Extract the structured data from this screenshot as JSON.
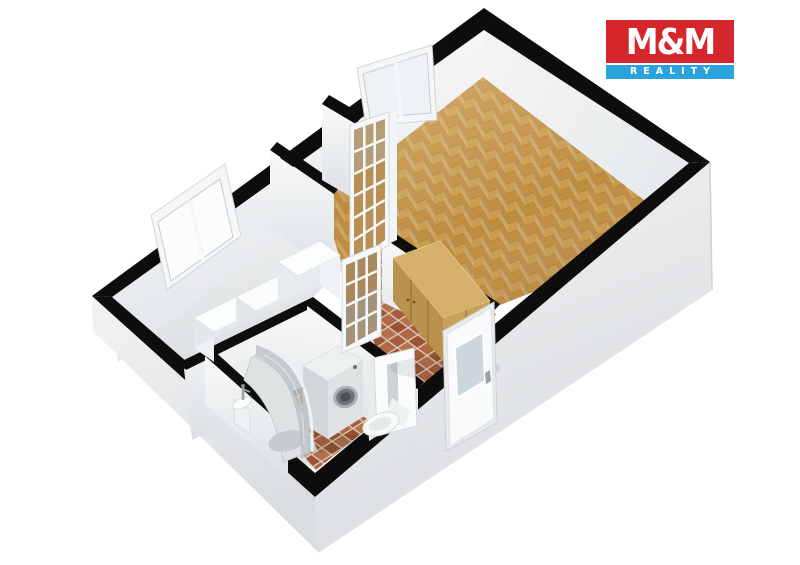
{
  "brand": {
    "name": "M&M",
    "tagline": "REALITY",
    "colors": {
      "red": "#d5262c",
      "blue": "#2aa3dd",
      "text": "#ffffff"
    }
  },
  "scene": {
    "type": "3d-floor-plan-render",
    "background": "#ffffff",
    "materials": {
      "wall_cap": "#0d0d0e",
      "wall_face_light": "#fbfcfd",
      "wall_face_shade": "#dde1e4",
      "wall_exterior": "#eef0f1",
      "wall_exterior_shade": "#d8dbdd",
      "floor_room_light": "#f3f4f5",
      "floor_room_shade": "#dfe2e4",
      "parquet_light": "#d2a55b",
      "parquet_dark": "#c08d3f",
      "tile_grout": "#d9c8ba",
      "tile_a": "#a65c38",
      "tile_b": "#b06743",
      "tile_c": "#9a5331",
      "tile_d": "#b5714d",
      "wardrobe_top": "#d4b06a",
      "wardrobe_front": "#bb924d",
      "wardrobe_side": "#c9a257",
      "glass": "#cdd6da",
      "appliance_white": "#f2f4f5"
    },
    "objects": [
      "left-room-window",
      "main-room-window",
      "glazed-interior-door",
      "white-counter",
      "wardrobe",
      "washing-machine",
      "corner-shower",
      "toilet",
      "washbasin",
      "bathroom-door",
      "entrance-door"
    ]
  }
}
